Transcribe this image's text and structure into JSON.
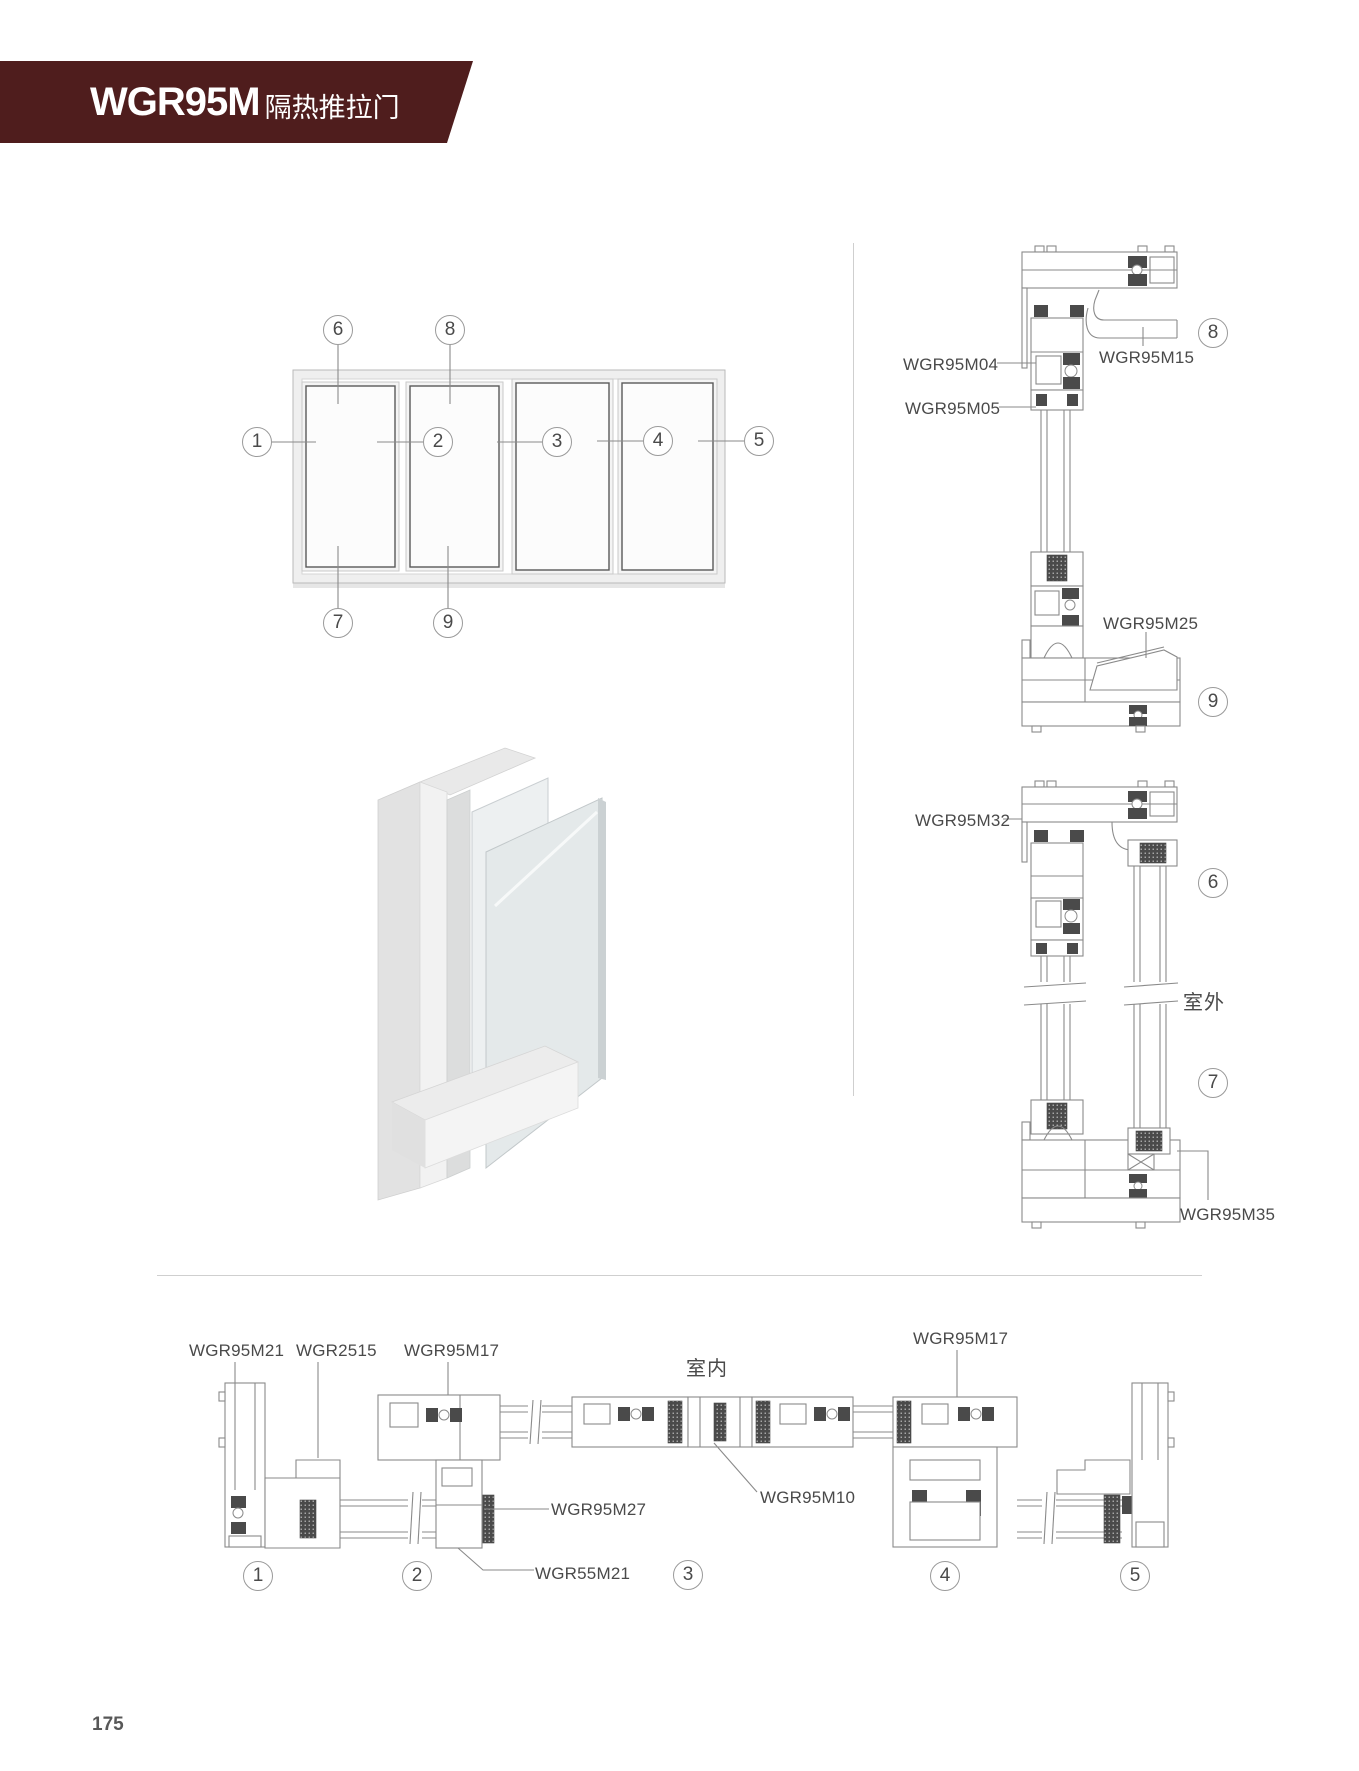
{
  "header": {
    "model": "WGR95M",
    "subtitle": "隔热推拉门",
    "banner_color": "#4f1d1d"
  },
  "page_number": "175",
  "section_labels": {
    "m04": "WGR95M04",
    "m05": "WGR95M05",
    "m15": "WGR95M15",
    "m25": "WGR95M25",
    "m32": "WGR95M32",
    "m35": "WGR95M35",
    "outdoor": "室外",
    "indoor": "室内",
    "m21": "WGR95M21",
    "w2515": "WGR2515",
    "m17_left": "WGR95M17",
    "m17_right": "WGR95M17",
    "m27": "WGR95M27",
    "w55m21": "WGR55M21",
    "m10": "WGR95M10"
  },
  "callouts": {
    "e1": "1",
    "e2": "2",
    "e3": "3",
    "e4": "4",
    "e5": "5",
    "e6": "6",
    "e7": "7",
    "e8": "8",
    "e9": "9",
    "a8": "8",
    "a9": "9",
    "b6": "6",
    "b7": "7",
    "c1": "1",
    "c2": "2",
    "c3": "3",
    "c4": "4",
    "c5": "5"
  }
}
